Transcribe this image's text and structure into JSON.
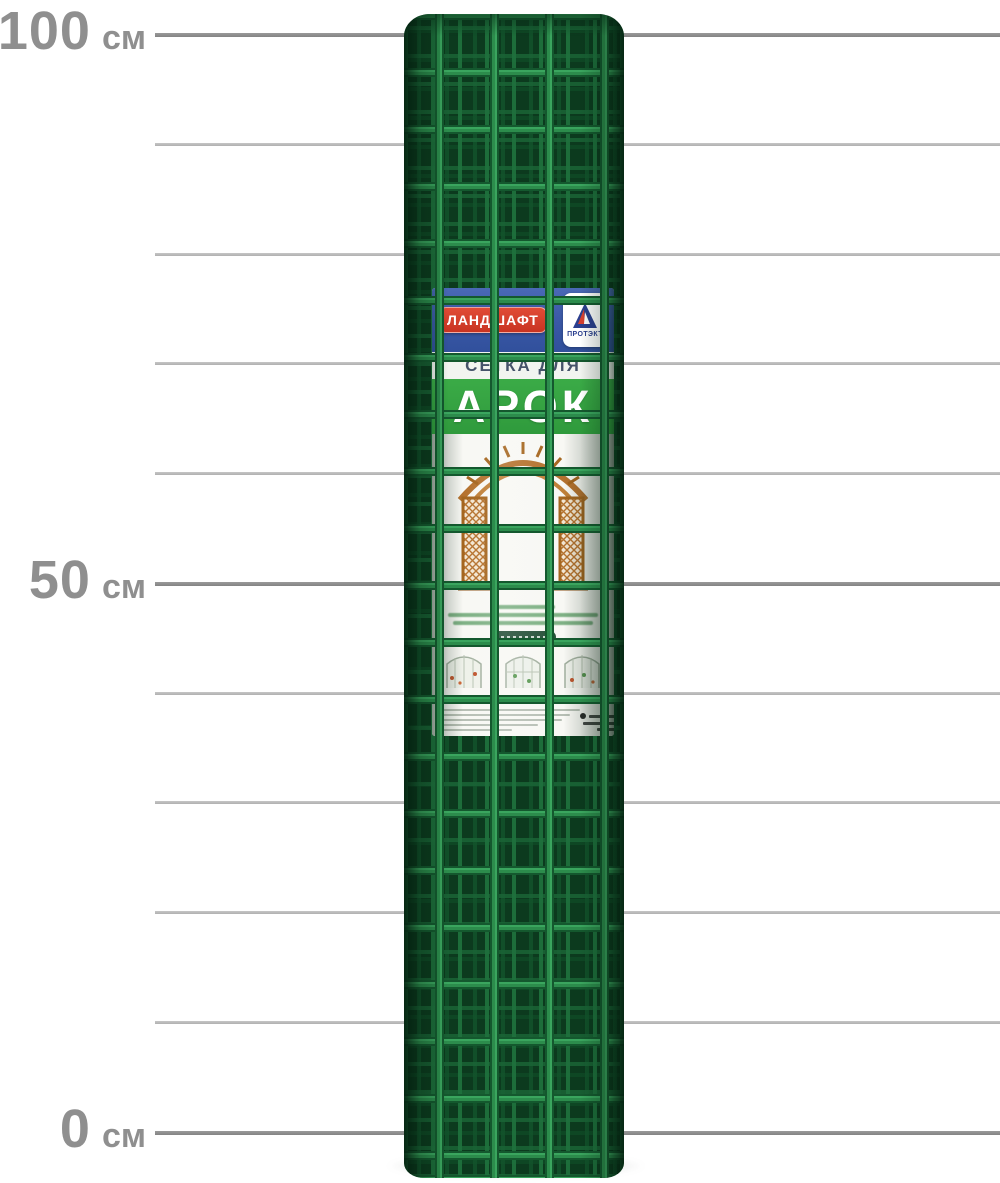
{
  "scale": {
    "labels": [
      {
        "value": "100",
        "unit": "см",
        "cm": 100
      },
      {
        "value": "50",
        "unit": "см",
        "cm": 50
      },
      {
        "value": "0",
        "unit": "см",
        "cm": 0
      }
    ],
    "gridlines_cm": [
      100,
      90,
      80,
      70,
      60,
      50,
      40,
      30,
      20,
      10,
      0
    ],
    "label_color": "#8f8f8f",
    "major_line_color": "#8c8c8c",
    "minor_line_color": "#bcbcbc"
  },
  "product": {
    "kind": "green plastic garden mesh roll",
    "mesh_color": "#1f7a40",
    "label": {
      "brand_badge": "ЛАНДШАФТ",
      "logo_text": "ПРОТЭКТ",
      "subtitle": "СЕТКА ДЛЯ",
      "title": "АРОК",
      "colors": {
        "band_blue": "#3a58a6",
        "badge_red": "#d8402f",
        "band_green": "#2f9a3c",
        "subtitle_text": "#46536a",
        "arch_brown": "#b5722e"
      }
    }
  }
}
